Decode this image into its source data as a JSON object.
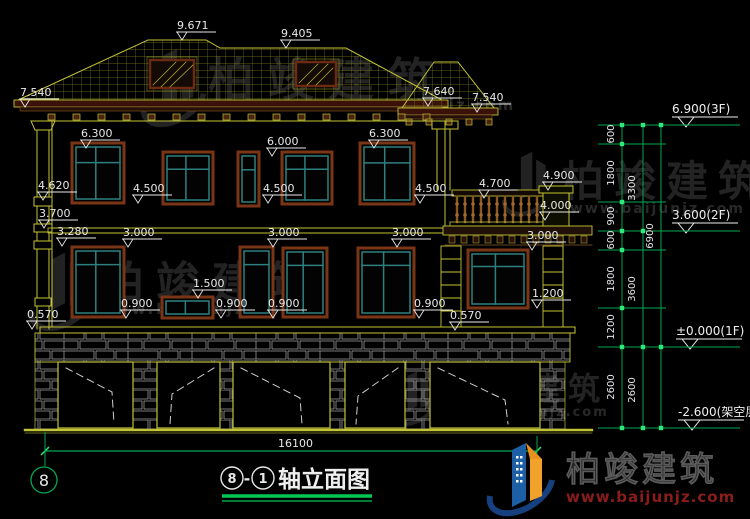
{
  "meta": {
    "drawing_type": "architectural-elevation",
    "total_width_dim": "16100"
  },
  "title": {
    "axis_start": "8",
    "separator": "-",
    "axis_end": "1",
    "text": "轴立面图"
  },
  "axis": {
    "left_bubble": "8"
  },
  "elevation_labels": [
    {
      "t": "9.671",
      "x": 182,
      "y": 40
    },
    {
      "t": "9.405",
      "x": 286,
      "y": 48
    },
    {
      "t": "7.540",
      "x": 25,
      "y": 107
    },
    {
      "t": "7.640",
      "x": 428,
      "y": 106
    },
    {
      "t": "7.540",
      "x": 477,
      "y": 112
    },
    {
      "t": "6.300",
      "x": 86,
      "y": 148
    },
    {
      "t": "6.000",
      "x": 272,
      "y": 156
    },
    {
      "t": "6.300",
      "x": 374,
      "y": 148
    },
    {
      "t": "4.620",
      "x": 43,
      "y": 200
    },
    {
      "t": "4.500",
      "x": 138,
      "y": 203
    },
    {
      "t": "4.500",
      "x": 268,
      "y": 203
    },
    {
      "t": "4.500",
      "x": 420,
      "y": 203
    },
    {
      "t": "4.700",
      "x": 484,
      "y": 198
    },
    {
      "t": "4.900",
      "x": 548,
      "y": 190
    },
    {
      "t": "4.000",
      "x": 545,
      "y": 220
    },
    {
      "t": "3.700",
      "x": 44,
      "y": 228
    },
    {
      "t": "3.280",
      "x": 62,
      "y": 246
    },
    {
      "t": "3.000",
      "x": 128,
      "y": 247
    },
    {
      "t": "3.000",
      "x": 273,
      "y": 247
    },
    {
      "t": "3.000",
      "x": 397,
      "y": 247
    },
    {
      "t": "3.000",
      "x": 532,
      "y": 250
    },
    {
      "t": "1.500",
      "x": 198,
      "y": 298
    },
    {
      "t": "0.900",
      "x": 126,
      "y": 318
    },
    {
      "t": "0.900",
      "x": 221,
      "y": 318
    },
    {
      "t": "0.900",
      "x": 273,
      "y": 318
    },
    {
      "t": "0.900",
      "x": 419,
      "y": 318
    },
    {
      "t": "1.200",
      "x": 537,
      "y": 308
    },
    {
      "t": "0.570",
      "x": 32,
      "y": 329
    },
    {
      "t": "0.570",
      "x": 455,
      "y": 330
    }
  ],
  "level_markers": [
    {
      "t": "6.900(3F)",
      "x": 686,
      "y": 127
    },
    {
      "t": "3.600(2F)",
      "x": 686,
      "y": 233
    },
    {
      "t": "±0.000(1F)",
      "x": 690,
      "y": 349
    },
    {
      "t": "-2.600(架空层)",
      "x": 692,
      "y": 430
    }
  ],
  "dim_chain": {
    "verticals": [
      622,
      643,
      661
    ],
    "levels": [
      125,
      144,
      202,
      231,
      250,
      308,
      347,
      428
    ],
    "long_levels": [
      125,
      231,
      347,
      428
    ],
    "ticks": {
      "622": [
        125,
        144,
        202,
        231,
        250,
        308,
        347,
        428
      ],
      "643": [
        125,
        231,
        347,
        428
      ],
      "661": [
        125,
        347,
        428
      ]
    },
    "segments": [
      {
        "t": "600",
        "x": 622,
        "y": 134
      },
      {
        "t": "1800",
        "x": 622,
        "y": 173
      },
      {
        "t": "900",
        "x": 622,
        "y": 216
      },
      {
        "t": "600",
        "x": 622,
        "y": 240
      },
      {
        "t": "1800",
        "x": 622,
        "y": 279
      },
      {
        "t": "1200",
        "x": 622,
        "y": 327
      },
      {
        "t": "2600",
        "x": 622,
        "y": 387
      },
      {
        "t": "3300",
        "x": 643,
        "y": 188
      },
      {
        "t": "3600",
        "x": 643,
        "y": 289
      },
      {
        "t": "2600",
        "x": 643,
        "y": 390
      },
      {
        "t": "6900",
        "x": 661,
        "y": 236
      }
    ]
  },
  "watermark": {
    "brand": "柏竣建筑",
    "url": "www.baijunjz.com"
  },
  "logo": {
    "brand": "柏竣建筑",
    "url": "www.baijunjz.com"
  },
  "colors": {
    "line_yellow": "#c3c336",
    "dim_green": "#00a84f",
    "tick_green": "#2ee87a",
    "text_white": "#e8e8e8",
    "frame_teal": "#2e8080",
    "frame_brown": "#7a3416",
    "logo_blue": "#1d5fa5",
    "logo_orange": "#f0a22a",
    "logo_url_red": "#8a1c1c"
  }
}
